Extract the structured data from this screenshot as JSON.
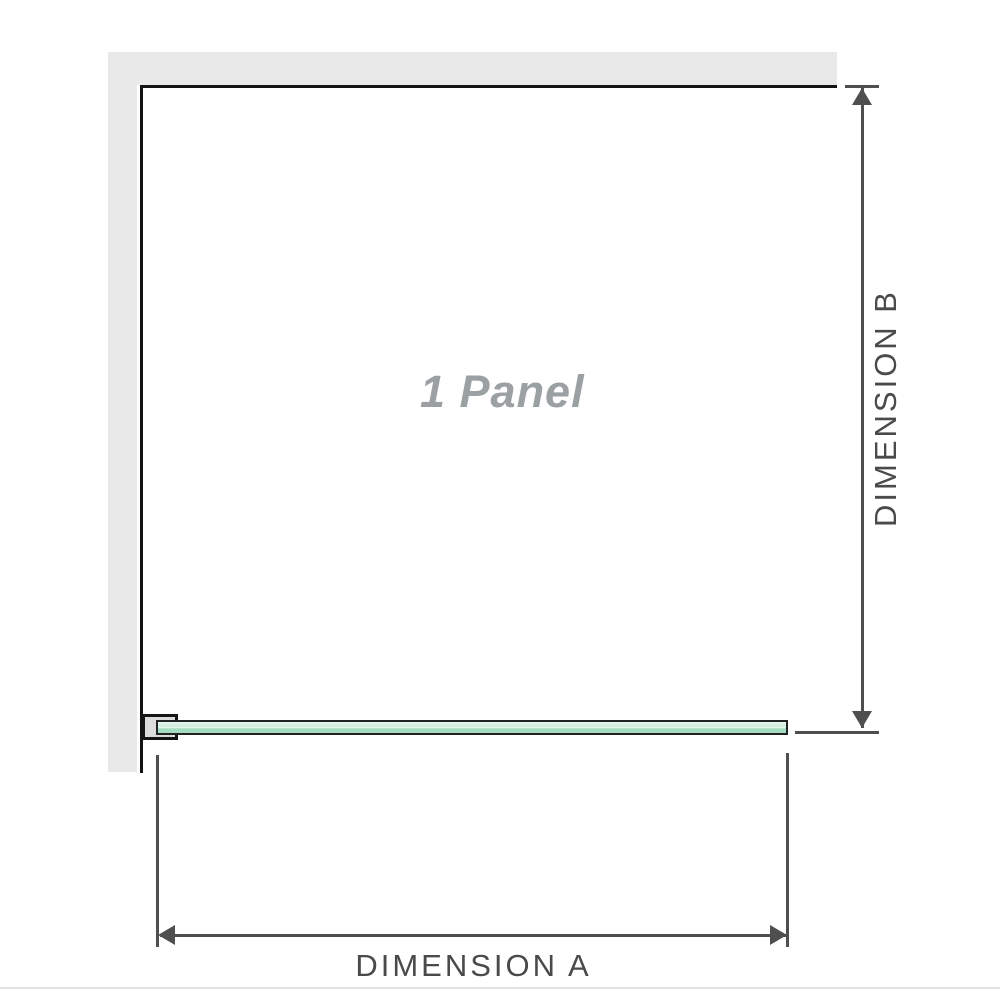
{
  "diagram": {
    "panel_label": "1 Panel",
    "dimension_a_label": "DIMENSION A",
    "dimension_b_label": "DIMENSION B"
  },
  "colors": {
    "wall-fill": "#e9e9e9",
    "wall-edge": "#141414",
    "glass-border": "#222222",
    "glass-light": "#e6f6ee",
    "glass-mid": "#c9ecd9",
    "glass-dark": "#a5dcc1",
    "dimension-line": "#4f4f4f",
    "dimension-text": "#4a4a4a",
    "panel-text": "#9ba0a3",
    "footer-line": "#e2e2e2",
    "canvas-bg": "#ffffff"
  }
}
